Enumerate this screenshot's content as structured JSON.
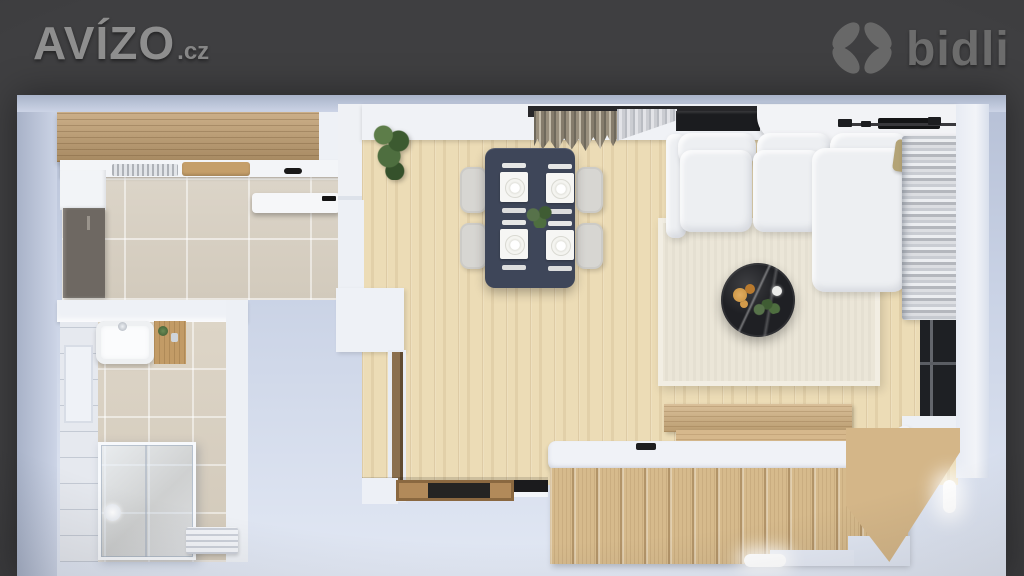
{
  "branding": {
    "avizo_text": "AVÍZO",
    "avizo_suffix": ".cz",
    "bidli_text": "bidli"
  },
  "palette": {
    "bg": "#3f3f41",
    "wall-deep": "#a8b2c8",
    "wood-floor": "#ecdcb6",
    "wood-cabinet": "#c2a072",
    "wood-stairs": "#d6ba8c",
    "tile-kitchen": "#d8d1c4",
    "tile-bath": "#d8d0c2",
    "bath-wall": "#e6e9ef",
    "table-navy": "#3e4659",
    "chair-grey": "#d7d6d2",
    "sofa-white": "#edeff2",
    "rug-cream": "#ebe6d8",
    "marble-black": "#1f2024",
    "window-dark": "#1b1c1f",
    "fridge-grey": "#6e6862",
    "accent-amber": "#c8913f",
    "doormat-black": "#242423",
    "logo-grey": "#8e8e8e",
    "bidli-grey": "#6c6c6c"
  },
  "scene": {
    "type": "3d-floorplan-top-view",
    "rooms": [
      "kitchen",
      "bathroom",
      "living-dining-room",
      "staircase"
    ]
  }
}
